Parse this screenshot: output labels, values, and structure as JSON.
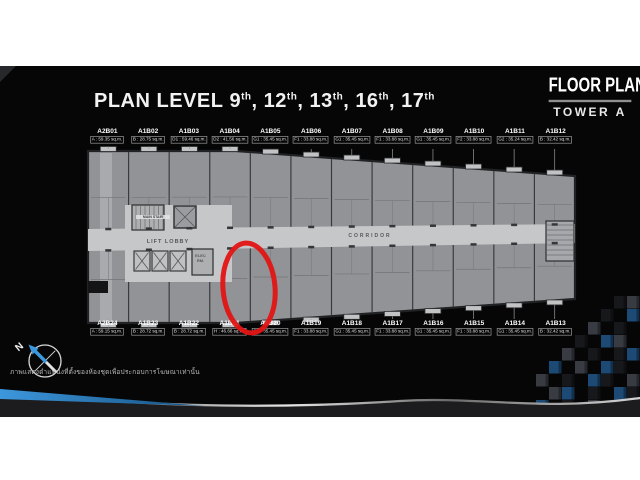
{
  "header": {
    "title_prefix": "PLAN LEVEL",
    "title_levels": [
      "9",
      "12",
      "13",
      "16",
      "17"
    ],
    "ordinal_suffix": "th",
    "brand_line1": "FLOOR PLAN",
    "brand_line2": "TOWER A"
  },
  "plan": {
    "corridor_label": "CORRIDOR",
    "lift_lobby_label": "LIFT LOBBY",
    "elec_room_label": "ELEC RM.",
    "stair_label": "MAIN STAIR",
    "highlighted_unit": "A1B21",
    "top_units": [
      {
        "name": "A2B01",
        "area": "A : 59.35 sq.m."
      },
      {
        "name": "A1B02",
        "area": "B : 28.75 sq.m."
      },
      {
        "name": "A1B03",
        "area": "D1 : 59.46 sq.m."
      },
      {
        "name": "A1B04",
        "area": "D2 : 41.56 sq.m."
      },
      {
        "name": "A1B05",
        "area": "G1 : 35.45 sq.m."
      },
      {
        "name": "A1B06",
        "area": "F1 : 33.88 sq.m."
      },
      {
        "name": "A1B07",
        "area": "G1 : 35.45 sq.m."
      },
      {
        "name": "A1B08",
        "area": "F1 : 33.88 sq.m."
      },
      {
        "name": "A1B09",
        "area": "G1 : 35.45 sq.m."
      },
      {
        "name": "A1B10",
        "area": "F2 : 33.88 sq.m."
      },
      {
        "name": "A1B11",
        "area": "G2 : 35.24 sq.m."
      },
      {
        "name": "A1B12",
        "area": "B : 32.42 sq.m."
      }
    ],
    "bottom_units": [
      {
        "name": "A2B24",
        "area": "A : 59.15 sq.m."
      },
      {
        "name": "A1B23",
        "area": "B : 28.72 sq.m."
      },
      {
        "name": "A1B22",
        "area": "B : 28.72 sq.m."
      },
      {
        "name": "A1B21",
        "area": "H : 46.66 sq.m."
      },
      {
        "name": "A1B20",
        "area": "G1 : 35.45 sq.m."
      },
      {
        "name": "A1B19",
        "area": "F1 : 33.88 sq.m."
      },
      {
        "name": "A1B18",
        "area": "G1 : 35.45 sq.m."
      },
      {
        "name": "A1B17",
        "area": "F1 : 33.88 sq.m."
      },
      {
        "name": "A1B16",
        "area": "G1 : 35.45 sq.m."
      },
      {
        "name": "A1B15",
        "area": "F1 : 33.88 sq.m."
      },
      {
        "name": "A1B14",
        "area": "G1 : 35.45 sq.m."
      },
      {
        "name": "A1B13",
        "area": "B : 32.42 sq.m."
      }
    ]
  },
  "compass": {
    "north_label": "N"
  },
  "footer": {
    "disclaimer_th": "ภาพแสดงตำแหน่งที่ตั้งของห้องชุดเพื่อประกอบการโฆษณาเท่านั้น"
  },
  "colors": {
    "background_black": "#060607",
    "plan_grey": "#919396",
    "corridor_grey": "#c6c7c9",
    "wall_dark": "#212224",
    "highlight_red": "#e31414",
    "accent_blue": "#3d97dd",
    "cube_colors": {
      "d": "#17181b",
      "g": "#383c42",
      "l": "#6e747d",
      "b": "#1c4a74",
      "s": "#2e6ca3"
    }
  }
}
